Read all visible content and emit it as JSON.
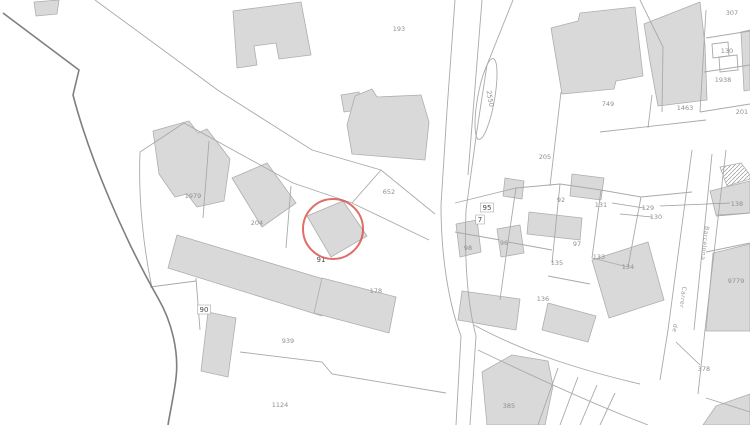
{
  "map": {
    "colors": {
      "background": "#ffffff",
      "parcel_line": "#a9a9a9",
      "municipal_boundary": "#7e7e7e",
      "building_fill": "#d9d9d9",
      "building_stroke": "#aeaeae",
      "label_faint": "#8f8f8f",
      "label_dark": "#4a4a4a",
      "highlight": "#d9544d"
    },
    "highlight_circle": {
      "cx": 333,
      "cy": 229,
      "r": 30
    },
    "labels": [
      {
        "t": "193",
        "x": 399,
        "y": 31
      },
      {
        "t": "652",
        "x": 389,
        "y": 194
      },
      {
        "t": "1979",
        "x": 193,
        "y": 198
      },
      {
        "t": "204",
        "x": 257,
        "y": 225
      },
      {
        "t": "91",
        "x": 321,
        "y": 262,
        "dark": true
      },
      {
        "t": "178",
        "x": 376,
        "y": 293
      },
      {
        "t": "90",
        "x": 204,
        "y": 312,
        "dark": true,
        "box": true
      },
      {
        "t": "939",
        "x": 288,
        "y": 343
      },
      {
        "t": "1124",
        "x": 280,
        "y": 407
      },
      {
        "t": "95",
        "x": 487,
        "y": 210,
        "dark": true,
        "box": true
      },
      {
        "t": "7",
        "x": 480,
        "y": 222,
        "dark": true,
        "box": true
      },
      {
        "t": "98",
        "x": 468,
        "y": 250
      },
      {
        "t": "96",
        "x": 504,
        "y": 245
      },
      {
        "t": "92",
        "x": 561,
        "y": 202
      },
      {
        "t": "131",
        "x": 601,
        "y": 207
      },
      {
        "t": "205",
        "x": 545,
        "y": 159
      },
      {
        "t": "97",
        "x": 577,
        "y": 246
      },
      {
        "t": "135",
        "x": 557,
        "y": 265
      },
      {
        "t": "133",
        "x": 599,
        "y": 259
      },
      {
        "t": "134",
        "x": 628,
        "y": 269
      },
      {
        "t": "136",
        "x": 543,
        "y": 301
      },
      {
        "t": "129",
        "x": 648,
        "y": 210
      },
      {
        "t": "130",
        "x": 656,
        "y": 219
      },
      {
        "t": "138",
        "x": 737,
        "y": 206
      },
      {
        "t": "749",
        "x": 608,
        "y": 106
      },
      {
        "t": "1463",
        "x": 685,
        "y": 110
      },
      {
        "t": "307",
        "x": 732,
        "y": 15
      },
      {
        "t": "130",
        "x": 727,
        "y": 53
      },
      {
        "t": "1938",
        "x": 723,
        "y": 82
      },
      {
        "t": "201",
        "x": 742,
        "y": 114
      },
      {
        "t": "9779",
        "x": 736,
        "y": 283
      },
      {
        "t": "378",
        "x": 704,
        "y": 371
      },
      {
        "t": "385",
        "x": 509,
        "y": 408
      },
      {
        "t": "2550",
        "x": 488,
        "y": 99,
        "rot": 80
      },
      {
        "t": "Barcelona",
        "x": 703,
        "y": 243,
        "rot": 97,
        "street": true
      },
      {
        "t": "Carrer",
        "x": 681,
        "y": 297,
        "rot": 97,
        "street": true
      },
      {
        "t": "de",
        "x": 673,
        "y": 328,
        "rot": 97,
        "street": true
      }
    ]
  }
}
